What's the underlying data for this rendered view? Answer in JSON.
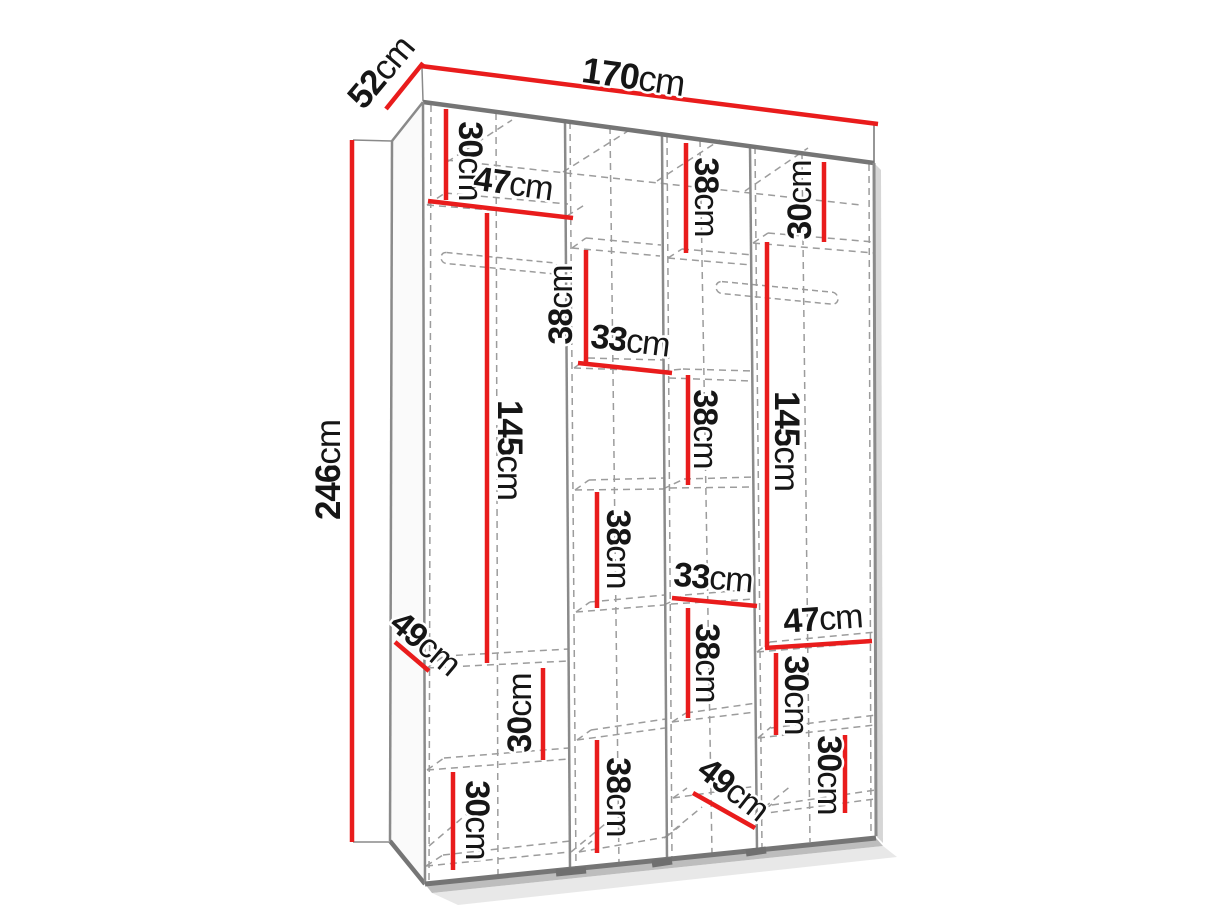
{
  "meta": {
    "description": "Perspective line drawing of a 4-section wardrobe with red dimension lines",
    "overall_dimensions_cm": {
      "width": "170cm",
      "depth": "52cm",
      "height": "246cm"
    }
  },
  "colors": {
    "background": "#ffffff",
    "red": "#e91c1c",
    "edge": "#8a8a8a",
    "edge_dark": "#757575",
    "dash": "#9c9c9c",
    "text": "#161616",
    "face_white": "#ffffff",
    "face_left": "#fafafa",
    "shadow_mid": "#9a9a9a",
    "shadow_soft": "#d2d2d2",
    "feet": "#6f6f6f"
  },
  "canvas": {
    "width": 1214,
    "height": 911
  },
  "diagram": {
    "faces": [
      {
        "name": "top-panel-face",
        "fill": "#ffffff",
        "points": [
          [
            421,
            66
          ],
          [
            878,
            124
          ],
          [
            874,
            163
          ],
          [
            423,
            102
          ]
        ]
      },
      {
        "name": "left-side-face",
        "fill": "#fafafa",
        "points": [
          [
            392,
            141
          ],
          [
            423,
            102
          ],
          [
            425,
            884
          ],
          [
            390,
            841
          ]
        ]
      },
      {
        "name": "front-face",
        "fill": "#ffffff",
        "points": [
          [
            423,
            102
          ],
          [
            874,
            163
          ],
          [
            876,
            836
          ],
          [
            425,
            884
          ]
        ]
      },
      {
        "name": "right-shadow",
        "fill": "#b5b5b5",
        "opacity": 0.55,
        "points": [
          [
            874,
            163
          ],
          [
            881,
            170
          ],
          [
            883,
            843
          ],
          [
            876,
            836
          ]
        ]
      },
      {
        "name": "bottom-shadow",
        "fill": "#9a9a9a",
        "opacity": 0.65,
        "points": [
          [
            425,
            884
          ],
          [
            876,
            838
          ],
          [
            883,
            846
          ],
          [
            432,
            893
          ]
        ]
      },
      {
        "name": "floor-soft-shadow",
        "fill": "#d2d2d2",
        "opacity": 0.5,
        "points": [
          [
            432,
            893
          ],
          [
            883,
            846
          ],
          [
            897,
            857
          ],
          [
            458,
            905
          ]
        ]
      }
    ],
    "edges": [
      [
        392,
        141,
        423,
        102,
        2.5
      ],
      [
        422,
        68,
        423,
        101,
        1.5
      ],
      [
        874,
        125,
        874,
        163,
        1.8
      ],
      [
        423,
        102,
        874,
        163,
        4.5
      ],
      [
        392,
        141,
        390,
        841,
        2.5
      ],
      [
        390,
        841,
        425,
        884,
        4.5
      ],
      [
        423,
        102,
        425,
        884,
        2.5
      ],
      [
        425,
        884,
        876,
        838,
        5
      ],
      [
        874,
        163,
        876,
        836,
        3
      ],
      [
        353,
        140,
        392,
        141,
        1.5
      ],
      [
        353,
        842,
        390,
        842,
        1.5
      ]
    ],
    "dividers": [
      [
        565,
        122,
        570,
        869
      ],
      [
        662,
        136,
        667,
        860
      ],
      [
        750,
        146,
        757,
        850
      ]
    ],
    "dashes": [
      [
        570,
        122,
        576,
        868
      ],
      [
        667,
        136,
        672,
        860
      ],
      [
        755,
        147,
        762,
        849
      ],
      [
        431,
        105,
        429,
        882
      ],
      [
        869,
        164,
        871,
        834
      ],
      [
        496,
        113,
        498,
        878
      ],
      [
        610,
        127,
        619,
        865
      ],
      [
        700,
        140,
        712,
        854
      ],
      [
        802,
        154,
        810,
        842
      ],
      [
        446,
        160,
        861,
        205
      ],
      [
        447,
        162,
        512,
        120
      ],
      [
        563,
        172,
        628,
        131
      ],
      [
        657,
        181,
        720,
        140
      ],
      [
        745,
        191,
        808,
        148
      ],
      [
        427,
        205,
        567,
        216
      ],
      [
        427,
        668,
        568,
        661
      ],
      [
        427,
        770,
        569,
        759
      ],
      [
        426,
        866,
        570,
        852
      ],
      [
        572,
        248,
        660,
        256
      ],
      [
        574,
        368,
        662,
        371
      ],
      [
        575,
        490,
        663,
        489
      ],
      [
        576,
        612,
        664,
        605
      ],
      [
        577,
        740,
        665,
        728
      ],
      [
        579,
        852,
        666,
        837
      ],
      [
        668,
        258,
        752,
        265
      ],
      [
        669,
        378,
        753,
        381
      ],
      [
        670,
        488,
        754,
        487
      ],
      [
        671,
        604,
        755,
        599
      ],
      [
        672,
        722,
        756,
        712
      ],
      [
        673,
        798,
        757,
        786
      ],
      [
        753,
        243,
        874,
        253
      ],
      [
        757,
        652,
        875,
        642
      ],
      [
        758,
        738,
        875,
        725
      ],
      [
        759,
        814,
        875,
        799
      ],
      [
        445,
        193,
        568,
        204
      ],
      [
        444,
        656,
        569,
        649
      ],
      [
        444,
        758,
        569,
        748
      ],
      [
        443,
        855,
        570,
        841
      ],
      [
        586,
        238,
        661,
        245
      ],
      [
        588,
        358,
        663,
        360
      ],
      [
        589,
        480,
        664,
        478
      ],
      [
        590,
        602,
        665,
        595
      ],
      [
        591,
        730,
        666,
        719
      ],
      [
        682,
        249,
        753,
        255
      ],
      [
        683,
        369,
        754,
        371
      ],
      [
        684,
        479,
        755,
        477
      ],
      [
        685,
        595,
        756,
        589
      ],
      [
        686,
        713,
        757,
        703
      ],
      [
        768,
        233,
        874,
        242
      ],
      [
        770,
        642,
        876,
        632
      ],
      [
        771,
        728,
        876,
        715
      ],
      [
        772,
        805,
        876,
        790
      ],
      [
        427,
        205,
        445,
        193
      ],
      [
        567,
        216,
        586,
        204
      ],
      [
        574,
        368,
        588,
        358
      ],
      [
        662,
        371,
        683,
        369
      ],
      [
        575,
        490,
        589,
        480
      ],
      [
        663,
        489,
        684,
        479
      ],
      [
        576,
        612,
        590,
        602
      ],
      [
        664,
        605,
        685,
        595
      ],
      [
        427,
        668,
        444,
        656
      ],
      [
        577,
        740,
        591,
        730
      ],
      [
        672,
        722,
        686,
        713
      ],
      [
        757,
        652,
        770,
        642
      ],
      [
        427,
        770,
        444,
        758
      ],
      [
        758,
        738,
        771,
        727
      ],
      [
        426,
        866,
        443,
        855
      ],
      [
        579,
        852,
        592,
        841
      ],
      [
        666,
        837,
        680,
        826
      ],
      [
        759,
        814,
        772,
        804
      ],
      [
        673,
        798,
        687,
        788
      ],
      [
        753,
        243,
        768,
        233
      ],
      [
        668,
        258,
        682,
        249
      ],
      [
        572,
        248,
        586,
        238
      ],
      [
        429,
        846,
        468,
        813
      ],
      [
        571,
        852,
        610,
        820
      ],
      [
        664,
        838,
        702,
        807
      ],
      [
        755,
        815,
        792,
        785
      ]
    ],
    "rails": [
      {
        "x": 441,
        "y": 252,
        "w": 117,
        "h": 11,
        "skew": 5.5
      },
      {
        "x": 716,
        "y": 281,
        "w": 122,
        "h": 12,
        "skew": 5.5
      }
    ],
    "feet": [
      [
        556,
        873,
        586,
        870
      ],
      [
        652,
        864,
        672,
        861
      ],
      [
        746,
        853,
        766,
        850
      ]
    ],
    "dimension_lines": [
      {
        "name": "depth-52",
        "pts": [
          386,
          109,
          423,
          63
        ]
      },
      {
        "name": "width-170",
        "pts": [
          421,
          66,
          878,
          124
        ]
      },
      {
        "name": "height-246",
        "pts": [
          352,
          140,
          352,
          842
        ]
      },
      {
        "name": "c1-top-30",
        "pts": [
          446,
          109,
          446,
          200
        ]
      },
      {
        "name": "c1-width-47",
        "pts": [
          428,
          201,
          573,
          218
        ]
      },
      {
        "name": "c2-top-38",
        "pts": [
          586,
          250,
          586,
          362
        ]
      },
      {
        "name": "c2-width-33",
        "pts": [
          578,
          363,
          672,
          373
        ]
      },
      {
        "name": "c3-top-38",
        "pts": [
          686,
          143,
          686,
          253
        ]
      },
      {
        "name": "c4-top-30",
        "pts": [
          824,
          162,
          824,
          242
        ]
      },
      {
        "name": "c4-hang-145",
        "pts": [
          767,
          242,
          767,
          647
        ]
      },
      {
        "name": "c1-hang-145",
        "pts": [
          487,
          213,
          487,
          663
        ]
      },
      {
        "name": "c2-mid-38",
        "pts": [
          597,
          492,
          597,
          608
        ]
      },
      {
        "name": "c3-mid-38",
        "pts": [
          688,
          375,
          688,
          485
        ]
      },
      {
        "name": "c3-width-33",
        "pts": [
          672,
          598,
          757,
          606
        ]
      },
      {
        "name": "c4-width-47",
        "pts": [
          765,
          648,
          872,
          641
        ]
      },
      {
        "name": "c4-mid-30",
        "pts": [
          776,
          653,
          776,
          735
        ]
      },
      {
        "name": "c4-low-30",
        "pts": [
          845,
          735,
          845,
          813
        ]
      },
      {
        "name": "c1-depth-49",
        "pts": [
          395,
          642,
          429,
          671
        ]
      },
      {
        "name": "c1-mid-30",
        "pts": [
          543,
          668,
          543,
          760
        ]
      },
      {
        "name": "c1-low-30",
        "pts": [
          453,
          772,
          453,
          870
        ]
      },
      {
        "name": "c2-low-38",
        "pts": [
          597,
          740,
          597,
          853
        ]
      },
      {
        "name": "c3-low-38",
        "pts": [
          688,
          608,
          688,
          718
        ]
      },
      {
        "name": "c3-depth-49",
        "pts": [
          693,
          793,
          755,
          828
        ]
      }
    ],
    "labels": [
      {
        "name": "label-depth-52",
        "num": "52",
        "unit": "cm",
        "x": 383,
        "y": 74,
        "rot": -50,
        "size": 35
      },
      {
        "name": "label-width-170",
        "num": "170",
        "unit": "cm",
        "x": 633,
        "y": 79,
        "rot": 8,
        "size": 36
      },
      {
        "name": "label-height-246",
        "num": "246",
        "unit": "cm",
        "x": 331,
        "y": 470,
        "rot": -90,
        "size": 35
      },
      {
        "name": "label-c1-top-30",
        "num": "30",
        "unit": "cm",
        "x": 468,
        "y": 161,
        "rot": 90,
        "size": 34
      },
      {
        "name": "label-c1-width-47",
        "num": "47",
        "unit": "cm",
        "x": 513,
        "y": 186,
        "rot": 8,
        "size": 34
      },
      {
        "name": "label-c2-top-38",
        "num": "38",
        "unit": "cm",
        "x": 563,
        "y": 305,
        "rot": -90,
        "size": 34
      },
      {
        "name": "label-c2-width-33",
        "num": "33",
        "unit": "cm",
        "x": 630,
        "y": 343,
        "rot": 7,
        "size": 34
      },
      {
        "name": "label-c3-top-38",
        "num": "38",
        "unit": "cm",
        "x": 704,
        "y": 197,
        "rot": 90,
        "size": 34
      },
      {
        "name": "label-c4-top-30",
        "num": "30",
        "unit": "cm",
        "x": 802,
        "y": 200,
        "rot": -90,
        "size": 34
      },
      {
        "name": "label-c4-hang-145",
        "num": "145",
        "unit": "cm",
        "x": 784,
        "y": 441,
        "rot": 90,
        "size": 35
      },
      {
        "name": "label-c1-hang-145",
        "num": "145",
        "unit": "cm",
        "x": 507,
        "y": 450,
        "rot": 90,
        "size": 35
      },
      {
        "name": "label-c2-mid-38",
        "num": "38",
        "unit": "cm",
        "x": 616,
        "y": 549,
        "rot": 90,
        "size": 34
      },
      {
        "name": "label-c3-mid-38",
        "num": "38",
        "unit": "cm",
        "x": 703,
        "y": 429,
        "rot": 90,
        "size": 34
      },
      {
        "name": "label-c3-width-33",
        "num": "33",
        "unit": "cm",
        "x": 713,
        "y": 580,
        "rot": 5,
        "size": 34
      },
      {
        "name": "label-c4-width-47",
        "num": "47",
        "unit": "cm",
        "x": 823,
        "y": 621,
        "rot": -4,
        "size": 34
      },
      {
        "name": "label-c4-mid-30",
        "num": "30",
        "unit": "cm",
        "x": 794,
        "y": 695,
        "rot": 90,
        "size": 34
      },
      {
        "name": "label-c4-low-30",
        "num": "30",
        "unit": "cm",
        "x": 827,
        "y": 775,
        "rot": 90,
        "size": 34
      },
      {
        "name": "label-c1-depth-49",
        "num": "49",
        "unit": "cm",
        "x": 424,
        "y": 645,
        "rot": 40,
        "size": 34
      },
      {
        "name": "label-c1-mid-30",
        "num": "30",
        "unit": "cm",
        "x": 522,
        "y": 713,
        "rot": -90,
        "size": 34
      },
      {
        "name": "label-c1-low-30",
        "num": "30",
        "unit": "cm",
        "x": 475,
        "y": 820,
        "rot": 90,
        "size": 34
      },
      {
        "name": "label-c2-low-38",
        "num": "38",
        "unit": "cm",
        "x": 616,
        "y": 797,
        "rot": 90,
        "size": 34
      },
      {
        "name": "label-c3-low-38",
        "num": "38",
        "unit": "cm",
        "x": 705,
        "y": 663,
        "rot": 90,
        "size": 34
      },
      {
        "name": "label-c3-depth-49",
        "num": "49",
        "unit": "cm",
        "x": 732,
        "y": 791,
        "rot": 38,
        "size": 34
      }
    ]
  }
}
